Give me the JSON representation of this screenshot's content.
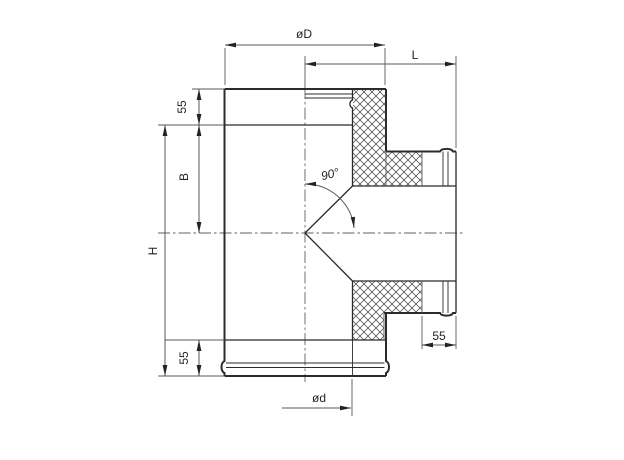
{
  "drawing": {
    "kind": "engineering-section-drawing",
    "subject": "90-degree insulated sandwich tee fitting, sectioned through branch",
    "colors": {
      "line": "#2b2b2b",
      "thin": "#5a5a5a",
      "hatch": "#3f3f3f",
      "bg": "#ffffff"
    }
  },
  "dimensions": {
    "outer_diameter_label": "øD",
    "branch_length_label": "L",
    "top_socket_label": "55",
    "branch_offset_label": "B",
    "body_height_label": "H",
    "bottom_socket_label": "55",
    "inner_diameter_label": "ød",
    "branch_socket_label": "55",
    "branch_angle_label": "90°"
  }
}
